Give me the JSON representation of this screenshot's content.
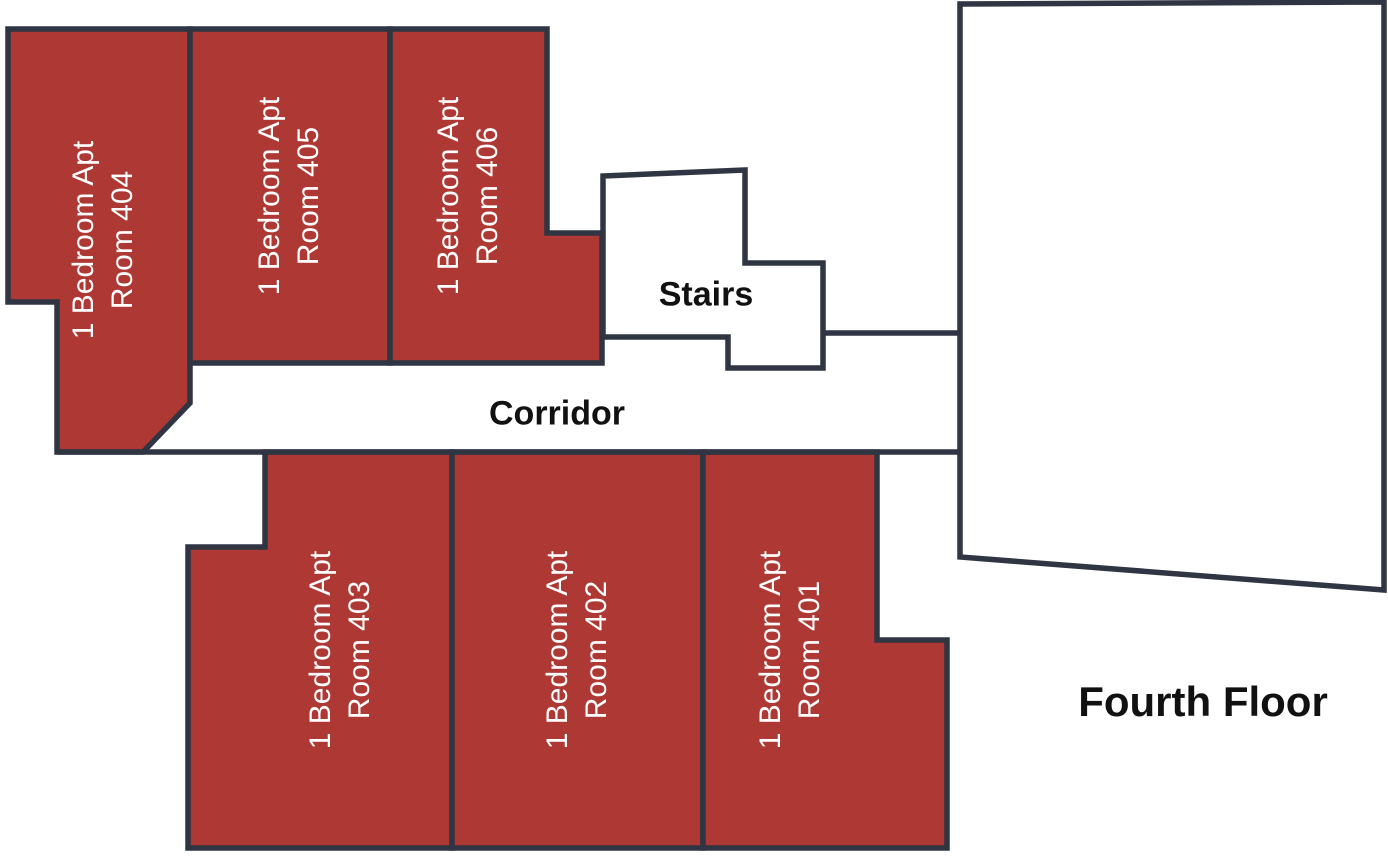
{
  "palette": {
    "room_fill": "#ae3834",
    "wall": "#2f3542",
    "room_text": "#ffffff",
    "label_text": "#111111"
  },
  "floor_title": "Fourth Floor",
  "areas": {
    "stairs": "Stairs",
    "corridor": "Corridor"
  },
  "rooms": [
    {
      "id": "404",
      "type": "1 Bedroom Apt",
      "room": "Room 404"
    },
    {
      "id": "405",
      "type": "1 Bedroom Apt",
      "room": "Room 405"
    },
    {
      "id": "406",
      "type": "1 Bedroom Apt",
      "room": "Room 406"
    },
    {
      "id": "403",
      "type": "1 Bedroom Apt",
      "room": "Room 403"
    },
    {
      "id": "402",
      "type": "1 Bedroom Apt",
      "room": "Room 402"
    },
    {
      "id": "401",
      "type": "1 Bedroom Apt",
      "room": "Room 401"
    }
  ]
}
